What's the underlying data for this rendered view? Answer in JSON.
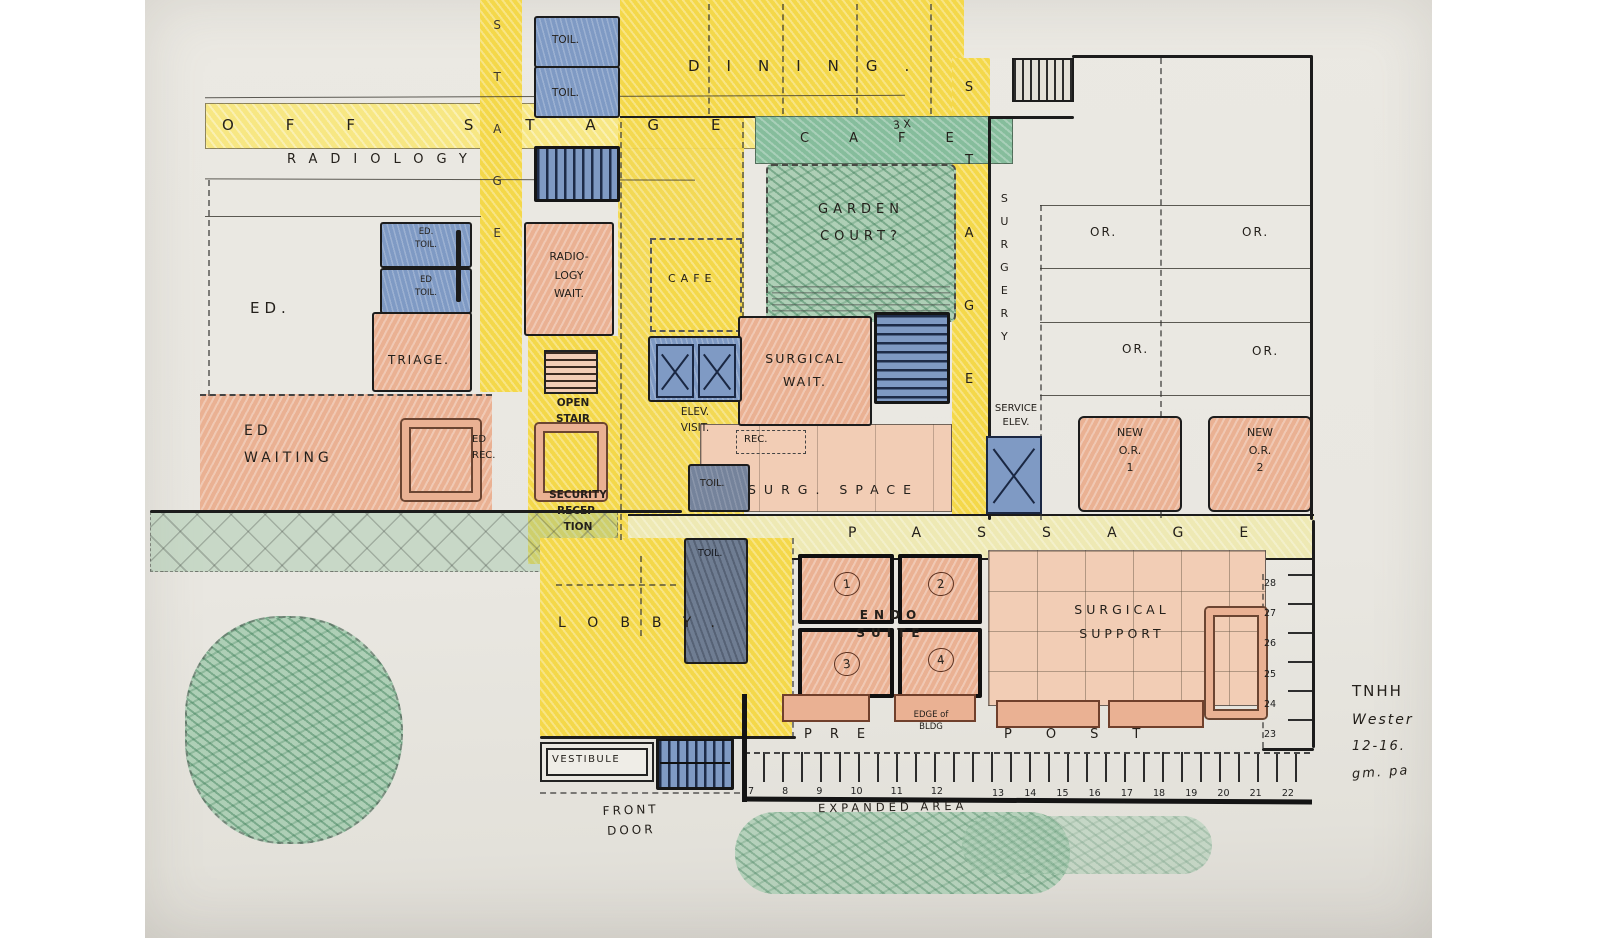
{
  "palette": {
    "paper": "#eae8e2",
    "ink": "#1c1c1c",
    "yellow": "#f4d84a",
    "yellow_light": "#f7e783",
    "yellow_pale": "#eee9b4",
    "salmon": "#eab193",
    "salmon_light": "#f2cdb5",
    "blue": "#7f9ac4",
    "blue_gray": "#75839b",
    "green": "#86bd9c",
    "green_light": "#aecfb6"
  },
  "labels": {
    "off_stage": "OFF STAGE",
    "radiology_band": "RADIOLOGY",
    "dining": "DINING.",
    "toil_top": [
      "TOIL.",
      "TOIL."
    ],
    "stage_left": "STAGE",
    "stage_right": "STAGE",
    "surgery": "SURGERY",
    "cafe_band": "CAFE",
    "garden_court": [
      "GARDEN",
      "COURT?"
    ],
    "dim_note": "3 X",
    "ed_toil": [
      [
        "ED.",
        "TOIL."
      ],
      [
        "ED",
        "TOIL."
      ]
    ],
    "ed": "ED.",
    "triage": "TRIAGE.",
    "radiology_wait": [
      "RADIO-",
      "LOGY",
      "WAIT."
    ],
    "cafe_room": "CAFE",
    "surgical_wait": [
      "SURGICAL",
      "WAIT."
    ],
    "or_rooms": [
      "OR.",
      "OR.",
      "OR.",
      "OR."
    ],
    "ed_waiting": [
      "ED",
      "WAITING"
    ],
    "ed_rec": [
      "ED",
      "REC."
    ],
    "open_stair": [
      "OPEN",
      "STAIR"
    ],
    "elev_visit": [
      "ELEV.",
      "VISIT."
    ],
    "rec": "REC.",
    "surg_space": "SURG. SPACE",
    "service_elev": [
      "SERVICE",
      "ELEV."
    ],
    "new_or_1": [
      "NEW",
      "O.R.",
      "1"
    ],
    "new_or_2": [
      "NEW",
      "O.R.",
      "2"
    ],
    "security": [
      "SECURITY",
      "RECEP-",
      "TION"
    ],
    "toil_mid_upper": "TOIL.",
    "toil_mid_lower": "TOIL.",
    "passage": "PASSAGE",
    "lobby": "LOBBY.",
    "endo_title": [
      "ENDO",
      "SUITE"
    ],
    "endo_rooms": [
      "1",
      "2",
      "3",
      "4"
    ],
    "surgical_support": [
      "SURGICAL",
      "SUPPORT"
    ],
    "bays_right": [
      "28",
      "27",
      "26",
      "25",
      "24",
      "23"
    ],
    "pre": "PRE",
    "edge_of_bldg": [
      "EDGE of",
      "BLDG"
    ],
    "post": "POST",
    "bays_left": [
      "7",
      "8",
      "9",
      "10",
      "11",
      "12"
    ],
    "bays_bottom": [
      "13",
      "14",
      "15",
      "16",
      "17",
      "18",
      "19",
      "20",
      "21",
      "22"
    ],
    "vestibule": "VESTIBULE",
    "front_door": [
      "FRONT",
      "DOOR"
    ],
    "expanded_area": "EXPANDED AREA",
    "note": [
      "TNHH",
      "Wester",
      "12-16.",
      "gm. pa"
    ]
  }
}
